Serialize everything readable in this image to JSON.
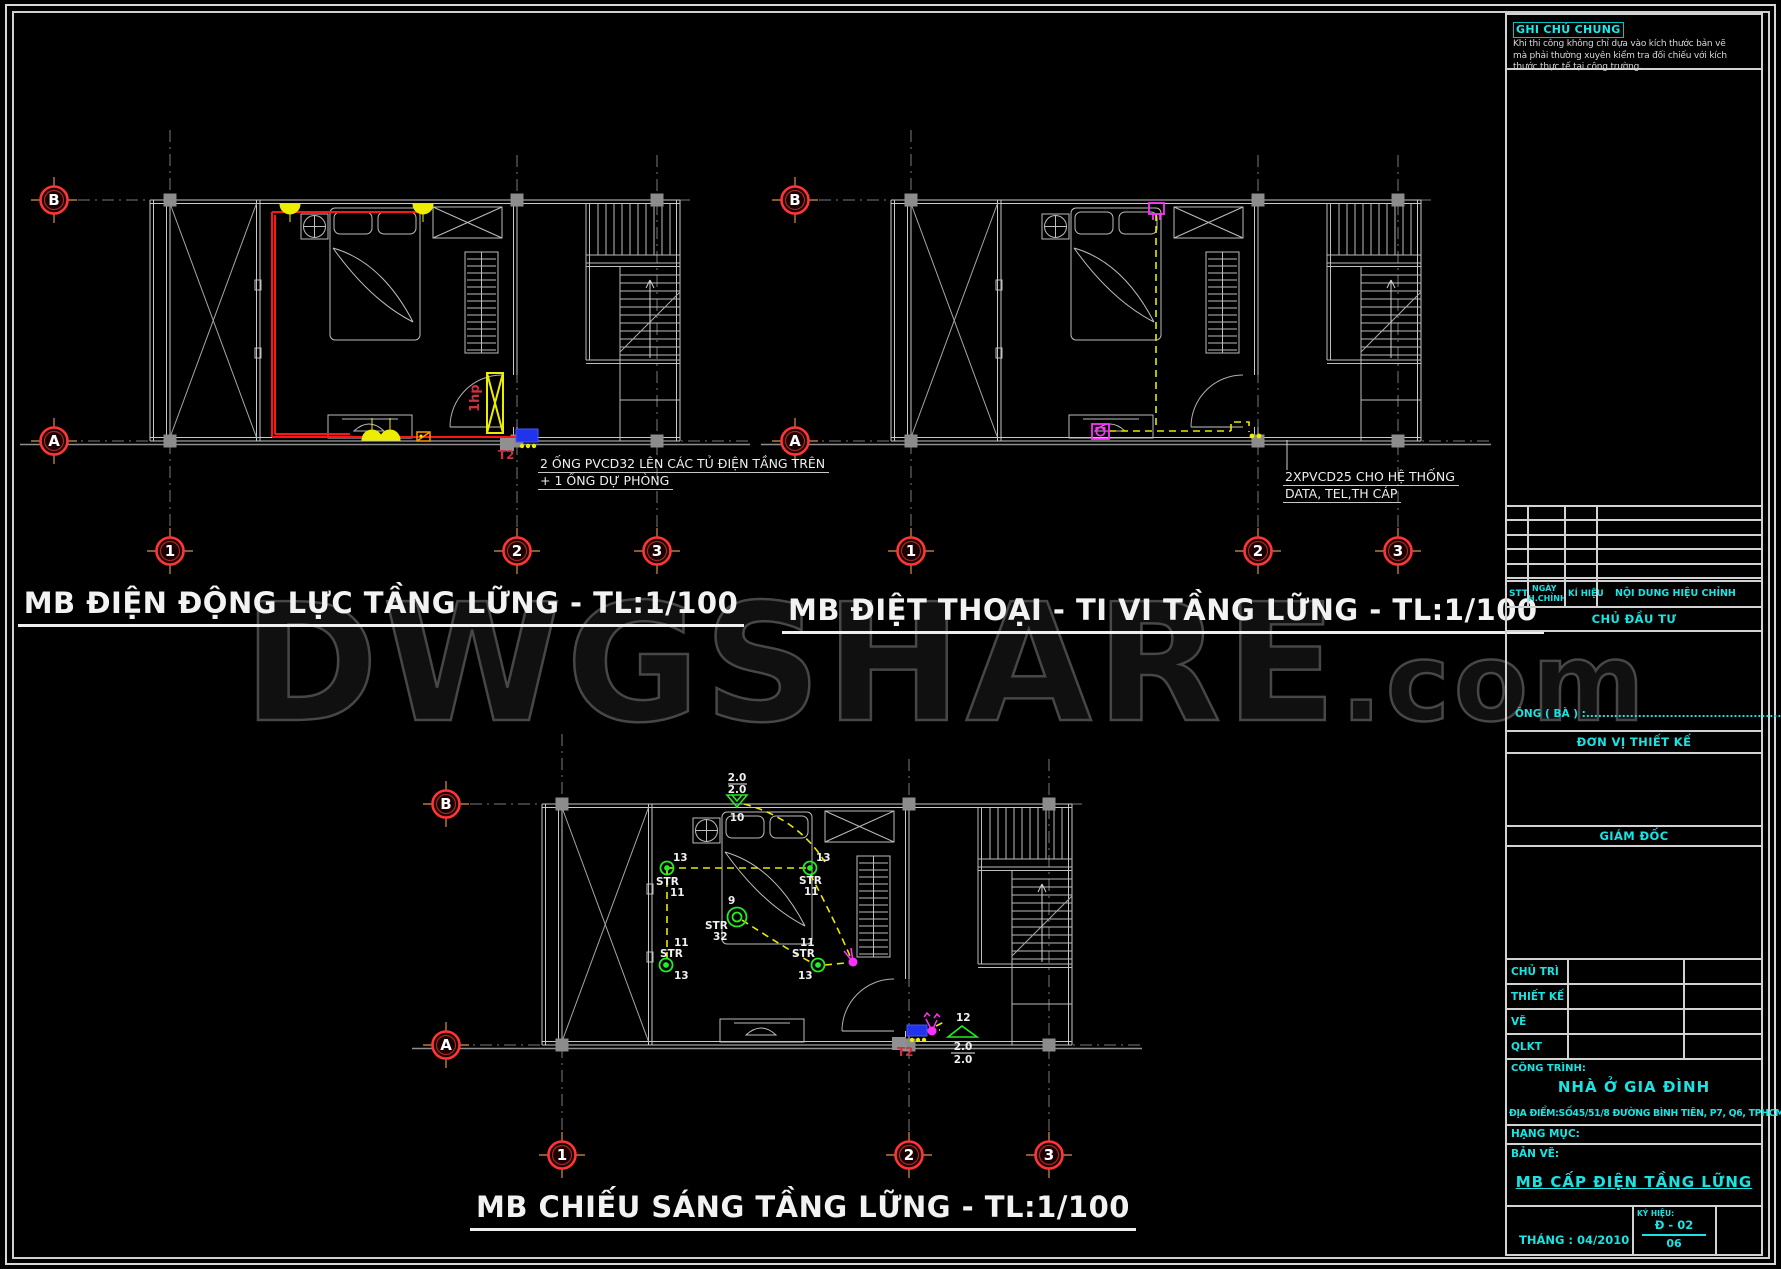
{
  "watermark": {
    "main": "DWGSHARE",
    "suffix": ".com"
  },
  "general_note": {
    "title": "GHI CHÚ CHUNG",
    "lines": [
      "Khi thi công không chỉ dựa vào kích thước bản vẽ",
      "mà phải thường xuyên kiểm tra đối chiếu với kích",
      "thước thực tế tại công trường."
    ]
  },
  "grid": {
    "row_b": "B",
    "row_a": "A",
    "col_1": "1",
    "col_2": "2",
    "col_3": "3"
  },
  "plans": {
    "power": {
      "title": "MB ĐIỆN ĐỘNG LỰC TẦNG LỮNG - TL:1/100",
      "note_line1": "2 ỐNG PVCD32 LÊN CÁC TỦ ĐIỆN TẦNG TRÊN",
      "note_line2": "+ 1 ỐNG DỰ PHÒNG",
      "panel_label": "1hp",
      "riser_label": "T2"
    },
    "tel_tv": {
      "title": "MB ĐIỆT THOẠI - TI VI TẦNG LỮNG - TL:1/100",
      "note_line1": "2XPVCD25 CHO HỆ THỐNG",
      "note_line2": "DATA, TEL,TH CÁP"
    },
    "lighting": {
      "title": "MB CHIẾU SÁNG TẦNG LỮNG - TL:1/100",
      "riser_label": "T2",
      "qty_13": "13",
      "str": "STR",
      "qty_11": "11",
      "center_qty": "9",
      "center_code": "32",
      "top_qty": "10",
      "dim": "2.0",
      "sw_qty": "12"
    }
  },
  "title_block": {
    "rev_headers": {
      "stt": "STT",
      "ngay": "NGÀY",
      "hchinh": "H.CHỈNH",
      "ki_hieu": "KÍ HIỆU",
      "noi_dung": "NỘI DUNG HIỆU CHỈNH"
    },
    "chu_dau_tu": "CHỦ ĐẦU TƯ",
    "ong_ba": "ÔNG ( BÀ ) :",
    "dots": "....................................................",
    "don_vi_thiet_ke": "ĐƠN VỊ THIẾT KẾ",
    "giam_doc": "GIÁM ĐỐC",
    "roles": {
      "chu_tri": "CHỦ TRÌ",
      "thiet_ke": "THIẾT KẾ",
      "ve": "VẼ",
      "qlkt": "QLKT"
    },
    "cong_trinh_label": "CÔNG TRÌNH:",
    "project_name": "NHÀ Ở GIA ĐÌNH",
    "address": "ĐỊA ĐIỂM:SỐ45/51/8 ĐƯỜNG BÌNH TIÊN, P7, Q6, TPHCM",
    "hang_muc_label": "HẠNG MỤC:",
    "ban_ve_label": "BẢN VẼ:",
    "drawing_name": "MB CẤP ĐIỆN TẦNG LỮNG",
    "month_label": "THÁNG : 04/2010",
    "ky_hieu_label": "KÝ HIỆU:",
    "sheet_code": "Đ - 02",
    "sheet_number": "06"
  },
  "colors": {
    "cyan": "#19E3E3",
    "red_wire": "#FF1515",
    "yellow": "#EDED00",
    "magenta": "#FF30FF",
    "green": "#22EE22",
    "blue": "#2233EE",
    "grid_bubble_ring": "#FF3535",
    "watermark_stroke": "#474747"
  }
}
